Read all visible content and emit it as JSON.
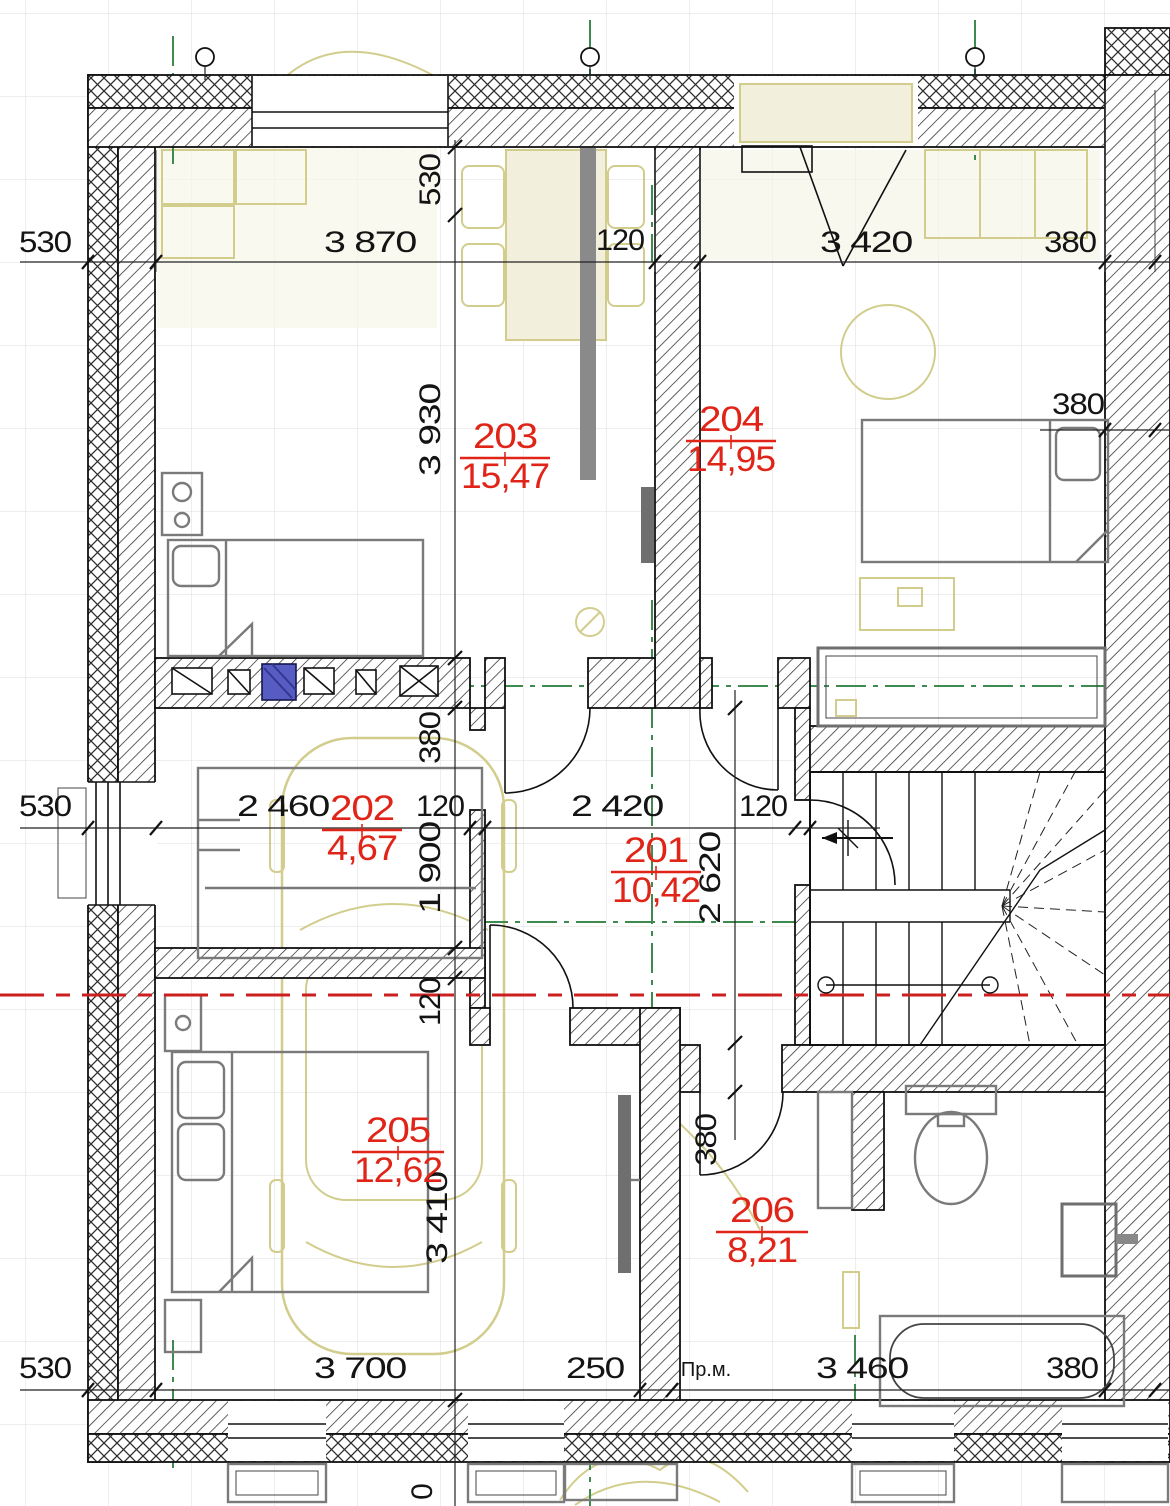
{
  "drawing": {
    "type": "architectural-floor-plan"
  },
  "rooms": [
    {
      "number": "201",
      "area": "10,42"
    },
    {
      "number": "202",
      "area": "4,67"
    },
    {
      "number": "203",
      "area": "15,47"
    },
    {
      "number": "204",
      "area": "14,95"
    },
    {
      "number": "205",
      "area": "12,62"
    },
    {
      "number": "206",
      "area": "8,21"
    }
  ],
  "dimensions": {
    "top_row": [
      "530",
      "3 870",
      "120",
      "3 420",
      "380"
    ],
    "middle_row": [
      "530",
      "2 460",
      "120",
      "2 420",
      "120"
    ],
    "bottom_row": [
      "530",
      "3 700",
      "250",
      "3 460",
      "380"
    ],
    "left_vertical_chain": [
      "530",
      "3 930",
      "380",
      "1 900",
      "120",
      "3 410",
      "0"
    ],
    "center_vertical_chain": [
      "2 620",
      "380"
    ],
    "right_wall_width": "380"
  },
  "annotations": {
    "premises_abbrev": "Пр.м."
  },
  "colors": {
    "room_label": "#e02518",
    "section_line": "#cc1f1f",
    "axis_line": "#3f8b4f",
    "furniture_outline": "#d2cd8d",
    "flue_marker": "#575cc2"
  }
}
